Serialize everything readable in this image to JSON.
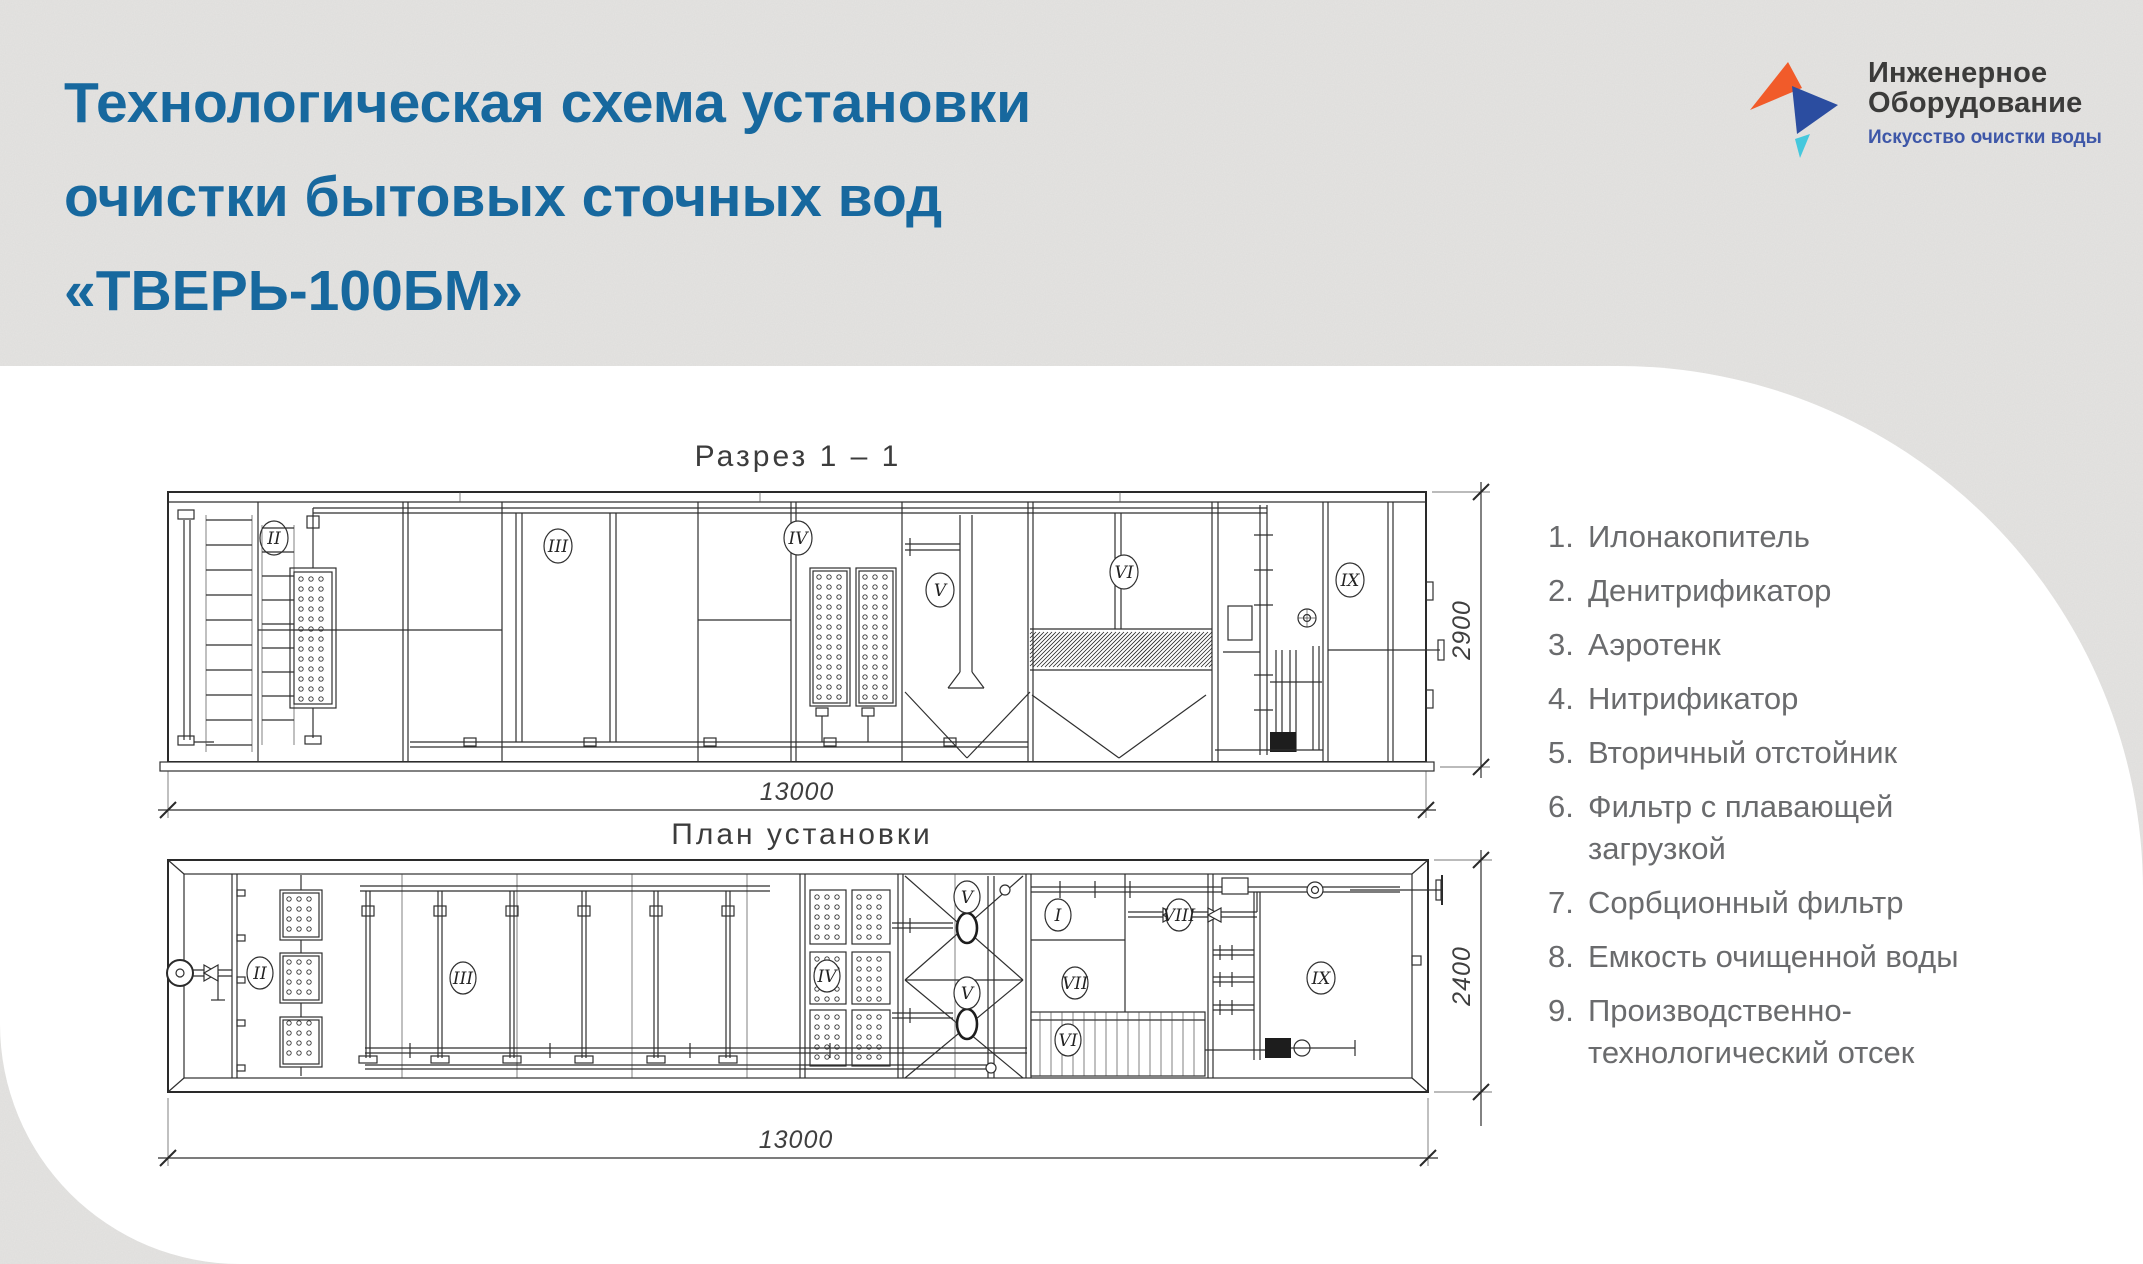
{
  "page": {
    "background": "#e5e4e2",
    "panel": "#ffffff",
    "accent": "#17689e"
  },
  "header": {
    "title_line1": "Технологическая схема установки",
    "title_line2": "очистки бытовых сточных вод",
    "title_line3": "«ТВЕРЬ-100БМ»"
  },
  "logo": {
    "name_line1": "Инженерное",
    "name_line2": "Оборудование",
    "tagline": "Искусство очистки воды",
    "colors": {
      "orange": "#f15b2a",
      "blue": "#2b4da0",
      "teal": "#45c8dd",
      "name_text": "#3b3b3a",
      "tagline_text": "#3e57a8"
    }
  },
  "drawings": {
    "section": {
      "title": "Разрез  1 – 1",
      "dim_width": "13000",
      "dim_height": "2900",
      "labels": [
        "II",
        "III",
        "IV",
        "V",
        "VI",
        "IX"
      ]
    },
    "plan": {
      "title": "План установки",
      "dim_width": "13000",
      "dim_height": "2400",
      "labels": [
        "II",
        "III",
        "IV",
        "V",
        "V",
        "I",
        "VIII",
        "VII",
        "VI",
        "IX"
      ]
    }
  },
  "legend": {
    "items": [
      {
        "num": "1.",
        "text": "Илонакопитель"
      },
      {
        "num": "2.",
        "text": "Денитрификатор"
      },
      {
        "num": "3.",
        "text": "Аэротенк"
      },
      {
        "num": "4.",
        "text": "Нитрификатор"
      },
      {
        "num": "5.",
        "text": "Вторичный отстойник"
      },
      {
        "num": "6.",
        "text": "Фильтр с плавающей загрузкой"
      },
      {
        "num": "7.",
        "text": "Сорбционный фильтр"
      },
      {
        "num": "8.",
        "text": "Емкость очищенной воды"
      },
      {
        "num": "9.",
        "text": "Производственно-технологический отсек"
      }
    ]
  }
}
